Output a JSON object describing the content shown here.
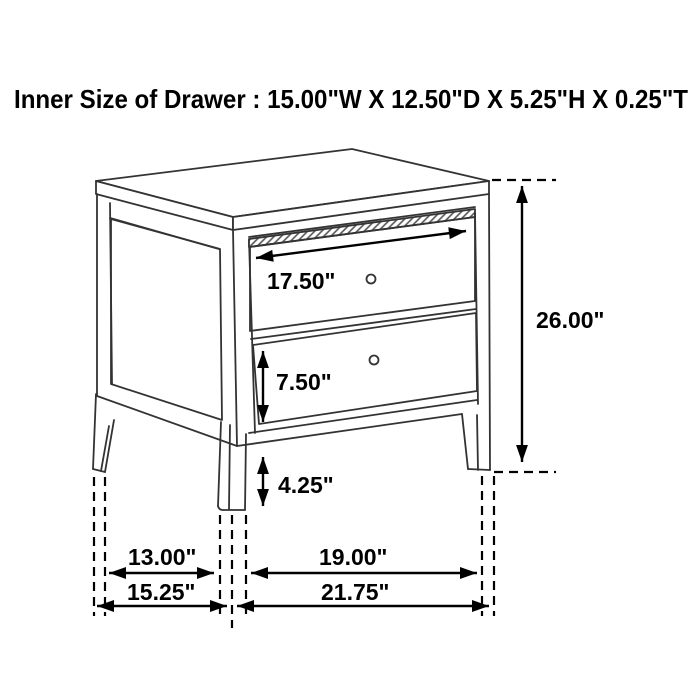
{
  "title": "Inner Size of Drawer : 15.00\"W X 12.50\"D X 5.25\"H X 0.25\"T",
  "diagram": {
    "type": "furniture-dimension-drawing",
    "subject": "two-drawer nightstand line drawing with dimension arrows",
    "labels": {
      "drawer_width": "17.50\"",
      "drawer_front_height": "7.50\"",
      "overall_height": "26.00\"",
      "leg_height": "4.25\"",
      "side_leg_gap": "13.00\"",
      "side_overall_depth": "15.25\"",
      "front_leg_gap": "19.00\"",
      "front_overall_width": "21.75\""
    },
    "inner_drawer_size": {
      "width": "15.00\"",
      "depth": "12.50\"",
      "height": "5.25\"",
      "thickness": "0.25\""
    },
    "colors": {
      "background": "#ffffff",
      "line_art": "#333333",
      "dimension": "#000000"
    }
  }
}
